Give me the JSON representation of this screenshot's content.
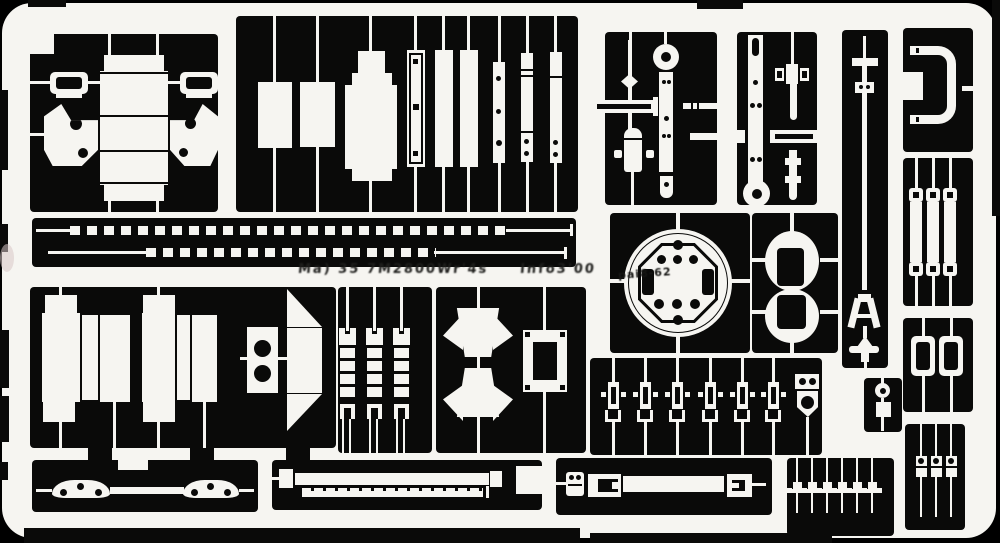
{
  "sheet": {
    "colors": {
      "film": "#0a0a09",
      "metal": "#f6f5f1",
      "background": "#000000",
      "scan_artifact": "#d9c6c6"
    },
    "etched_text": {
      "main": "Ma) 35 7M2800Wr'4s",
      "info": "Info3'00",
      "disc": "pai8-62"
    }
  }
}
